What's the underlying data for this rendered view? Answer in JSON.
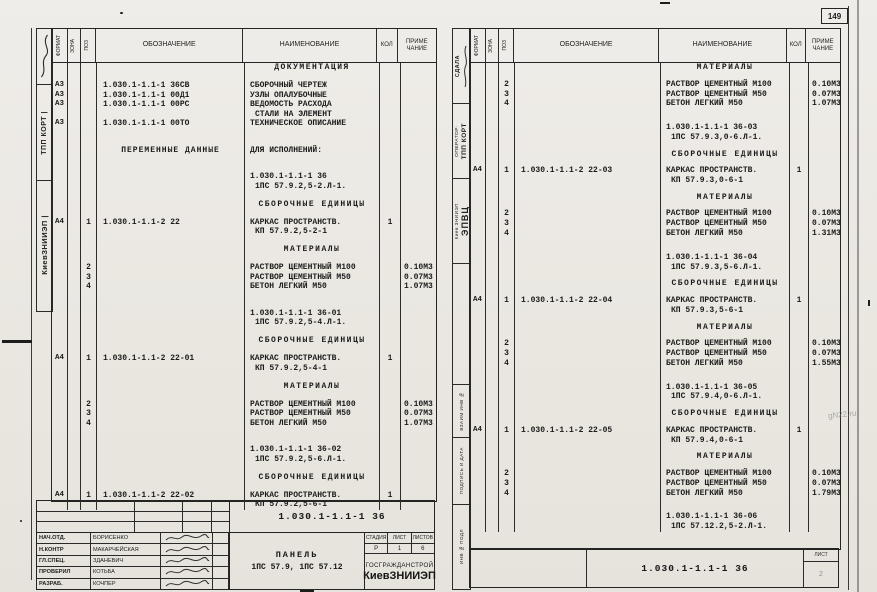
{
  "page": {
    "corner_number": "149",
    "watermark": "gN22.ru"
  },
  "columns": {
    "format": "ФОРМАТ",
    "zone": "ЗОНА",
    "pos": "ПОЗ",
    "designation": "ОБОЗНАЧЕНИЕ",
    "name": "НАИМЕНОВАНИЕ",
    "qty": "КОЛ",
    "note1": "ПРИМЕ",
    "note2": "ЧАНИЕ"
  },
  "left_sheet": {
    "margin": {
      "stamp1": "ТПП КОРТ |",
      "stamp2": "КиевЗНИИЭП |"
    },
    "lines": [
      {
        "n": "ДОКУМЕНТАЦИЯ",
        "s": "h"
      },
      {
        "s": "sp"
      },
      {
        "f": "А3",
        "d": "1.030.1-1.1-1 36СВ",
        "n": "СБОРОЧНЫЙ ЧЕРТЕЖ"
      },
      {
        "f": "А3",
        "d": "1.030.1-1.1-1 00Д1",
        "n": "УЗЛЫ ОПАЛУБОЧНЫЕ"
      },
      {
        "f": "А3",
        "d": "1.030.1-1.1-1 00РС",
        "n": "ВЕДОМОСТЬ РАСХОДА"
      },
      {
        "n": "СТАЛИ НА ЭЛЕМЕНТ",
        "s": "i"
      },
      {
        "f": "А3",
        "d": "1.030.1-1.1-1 00ТО",
        "n": "ТЕХНИЧЕСКОЕ ОПИСАНИЕ"
      },
      {
        "s": "sp"
      },
      {
        "s": "sp"
      },
      {
        "d": "ПЕРЕМЕННЫЕ ДАННЫЕ",
        "n": "ДЛЯ ИСПОЛНЕНИЙ:",
        "s": "dc"
      },
      {
        "s": "sp"
      },
      {
        "s": "sp"
      },
      {
        "n": "1.030.1-1.1-1 36"
      },
      {
        "n": "1ПС 57.9.2,5-2.Л-1.",
        "s": "i"
      },
      {
        "s": "sp"
      },
      {
        "n": "СБОРОЧНЫЕ ЕДИНИЦЫ",
        "s": "h"
      },
      {
        "s": "sp"
      },
      {
        "f": "А4",
        "p": "1",
        "d": "1.030.1-1.1-2 22",
        "n": "КАРКАС ПРОСТРАНСТВ.",
        "q": "1"
      },
      {
        "n": "КП 57.9.2,5-2-1",
        "s": "i"
      },
      {
        "s": "sp"
      },
      {
        "n": "МАТЕРИАЛЫ",
        "s": "h"
      },
      {
        "s": "sp"
      },
      {
        "p": "2",
        "n": "РАСТВОР ЦЕМЕНТНЫЙ М100",
        "r": "0.10М3"
      },
      {
        "p": "3",
        "n": "РАСТВОР ЦЕМЕНТНЫЙ М50",
        "r": "0.07М3"
      },
      {
        "p": "4",
        "n": "БЕТОН ЛЕГКИЙ М50",
        "r": "1.07М3"
      },
      {
        "s": "sp"
      },
      {
        "s": "sp"
      },
      {
        "n": "1.030.1-1.1-1 36-01"
      },
      {
        "n": "1ПС 57.9.2,5-4.Л-1.",
        "s": "i"
      },
      {
        "s": "sp"
      },
      {
        "n": "СБОРОЧНЫЕ ЕДИНИЦЫ",
        "s": "h"
      },
      {
        "s": "sp"
      },
      {
        "f": "А4",
        "p": "1",
        "d": "1.030.1-1.1-2 22-01",
        "n": "КАРКАС ПРОСТРАНСТВ.",
        "q": "1"
      },
      {
        "n": "КП 57.9.2,5-4-1",
        "s": "i"
      },
      {
        "s": "sp"
      },
      {
        "n": "МАТЕРИАЛЫ",
        "s": "h"
      },
      {
        "s": "sp"
      },
      {
        "p": "2",
        "n": "РАСТВОР ЦЕМЕНТНЫЙ М100",
        "r": "0.10М3"
      },
      {
        "p": "3",
        "n": "РАСТВОР ЦЕМЕНТНЫЙ М50",
        "r": "0.07М3"
      },
      {
        "p": "4",
        "n": "БЕТОН ЛЕГКИЙ М50",
        "r": "1.07М3"
      },
      {
        "s": "sp"
      },
      {
        "s": "sp"
      },
      {
        "n": "1.030.1-1.1-1 36-02"
      },
      {
        "n": "1ПС 57.9.2,5-6.Л-1.",
        "s": "i"
      },
      {
        "s": "sp"
      },
      {
        "n": "СБОРОЧНЫЕ ЕДИНИЦЫ",
        "s": "h"
      },
      {
        "s": "sp"
      },
      {
        "f": "А4",
        "p": "1",
        "d": "1.030.1-1.1-2 22-02",
        "n": "КАРКАС ПРОСТРАНСТВ.",
        "q": "1"
      },
      {
        "n": "КП 57.9.2,5-6-1",
        "s": "i"
      }
    ],
    "doc_number": "1.030.1-1.1-1 36",
    "title_block": {
      "rows": [
        {
          "role": "НАЧ.ОТД.",
          "name": "БОРИСЕНКО"
        },
        {
          "role": "Н.КОНТР",
          "name": "МАКАРЧЕЙСКАЯ"
        },
        {
          "role": "ГЛ.СПЕЦ.",
          "name": "ЗДАНЕВИЧ"
        },
        {
          "role": "ПРОВЕРИЛ",
          "name": "КОТЬБА"
        },
        {
          "role": "РАЗРАБ.",
          "name": "КОЧПЕР"
        }
      ],
      "title_line1": "ПАНЕЛЬ",
      "title_line2": "1ПС 57.9, 1ПС 57.12",
      "stage_label": "СТАДИЯ",
      "sheet_label": "ЛИСТ",
      "sheets_label": "ЛИСТОВ",
      "stage": "Р",
      "sheet": "1",
      "sheets": "6",
      "org_line1": "ГОСГРАЖДАНСТРОЙ",
      "org_line2": "КиевЗНИИЭП"
    }
  },
  "right_sheet": {
    "margin": {
      "sdala": "СДАЛА",
      "operator": "ОПЕРАТОР·",
      "tpp": "ТПП КОРТ",
      "epvc": "ЭПВЦ",
      "kiev": "Киев ЗНИИЭП",
      "vzaim": "ВЗАИМ ИНВ №",
      "podpis": "ПОДПИСЬ И ДАТА",
      "inv": "ИНВ № ПОДЛ"
    },
    "lines": [
      {
        "n": "МАТЕРИАЛЫ",
        "s": "h"
      },
      {
        "s": "sp"
      },
      {
        "p": "2",
        "n": "РАСТВОР ЦЕМЕНТНЫЙ М100",
        "r": "0.10М3"
      },
      {
        "p": "3",
        "n": "РАСТВОР ЦЕМЕНТНЫЙ М50",
        "r": "0.07М3"
      },
      {
        "p": "4",
        "n": "БЕТОН ЛЕГКИЙ М50",
        "r": "1.07М3"
      },
      {
        "s": "sp"
      },
      {
        "s": "sp"
      },
      {
        "n": "1.030.1-1.1-1 36-03"
      },
      {
        "n": "1ПС 57.9.3,0-6.Л-1.",
        "s": "i"
      },
      {
        "s": "sp"
      },
      {
        "n": "СБОРОЧНЫЕ ЕДИНИЦЫ",
        "s": "h"
      },
      {
        "s": "sp"
      },
      {
        "f": "А4",
        "p": "1",
        "d": "1.030.1-1.1-2 22-03",
        "n": "КАРКАС ПРОСТРАНСТВ.",
        "q": "1"
      },
      {
        "n": "КП 57.9.3,0-6-1",
        "s": "i"
      },
      {
        "s": "sp"
      },
      {
        "n": "МАТЕРИАЛЫ",
        "s": "h"
      },
      {
        "s": "sp"
      },
      {
        "p": "2",
        "n": "РАСТВОР ЦЕМЕНТНЫЙ М100",
        "r": "0.10М3"
      },
      {
        "p": "3",
        "n": "РАСТВОР ЦЕМЕНТНЫЙ М50",
        "r": "0.07М3"
      },
      {
        "p": "4",
        "n": "БЕТОН ЛЕГКИЙ М50",
        "r": "1.31М3"
      },
      {
        "s": "sp"
      },
      {
        "s": "sp"
      },
      {
        "n": "1.030.1-1.1-1 36-04"
      },
      {
        "n": "1ПС 57.9.3,5-6.Л-1.",
        "s": "i"
      },
      {
        "s": "sp"
      },
      {
        "n": "СБОРОЧНЫЕ ЕДИНИЦЫ",
        "s": "h"
      },
      {
        "s": "sp"
      },
      {
        "f": "А4",
        "p": "1",
        "d": "1.030.1-1.1-2 22-04",
        "n": "КАРКАС ПРОСТРАНСТВ.",
        "q": "1"
      },
      {
        "n": "КП 57.9.3,5-6-1",
        "s": "i"
      },
      {
        "s": "sp"
      },
      {
        "n": "МАТЕРИАЛЫ",
        "s": "h"
      },
      {
        "s": "sp"
      },
      {
        "p": "2",
        "n": "РАСТВОР ЦЕМЕНТНЫЙ М100",
        "r": "0.10М3"
      },
      {
        "p": "3",
        "n": "РАСТВОР ЦЕМЕНТНЫЙ М50",
        "r": "0.07М3"
      },
      {
        "p": "4",
        "n": "БЕТОН ЛЕГКИЙ М50",
        "r": "1.55М3"
      },
      {
        "s": "sp"
      },
      {
        "s": "sp"
      },
      {
        "n": "1.030.1-1.1-1 36-05"
      },
      {
        "n": "1ПС 57.9.4,0-6.Л-1.",
        "s": "i"
      },
      {
        "s": "sp"
      },
      {
        "n": "СБОРОЧНЫЕ ЕДИНИЦЫ",
        "s": "h"
      },
      {
        "s": "sp"
      },
      {
        "f": "А4",
        "p": "1",
        "d": "1.030.1-1.1-2 22-05",
        "n": "КАРКАС ПРОСТРАНСТВ.",
        "q": "1"
      },
      {
        "n": "КП 57.9.4,0-6-1",
        "s": "i"
      },
      {
        "s": "sp"
      },
      {
        "n": "МАТЕРИАЛЫ",
        "s": "h"
      },
      {
        "s": "sp"
      },
      {
        "p": "2",
        "n": "РАСТВОР ЦЕМЕНТНЫЙ М100",
        "r": "0.10М3"
      },
      {
        "p": "3",
        "n": "РАСТВОР ЦЕМЕНТНЫЙ М50",
        "r": "0.07М3"
      },
      {
        "p": "4",
        "n": "БЕТОН ЛЕГКИЙ М50",
        "r": "1.79М3"
      },
      {
        "s": "sp"
      },
      {
        "s": "sp"
      },
      {
        "n": "1.030.1-1.1-1 36-06"
      },
      {
        "n": "1ПС 57.12.2,5-2.Л-1.",
        "s": "i"
      }
    ],
    "footer_doc_number": "1.030.1-1.1-1 36",
    "footer_sheet_label": "ЛИСТ",
    "footer_sheet_value": "2"
  }
}
